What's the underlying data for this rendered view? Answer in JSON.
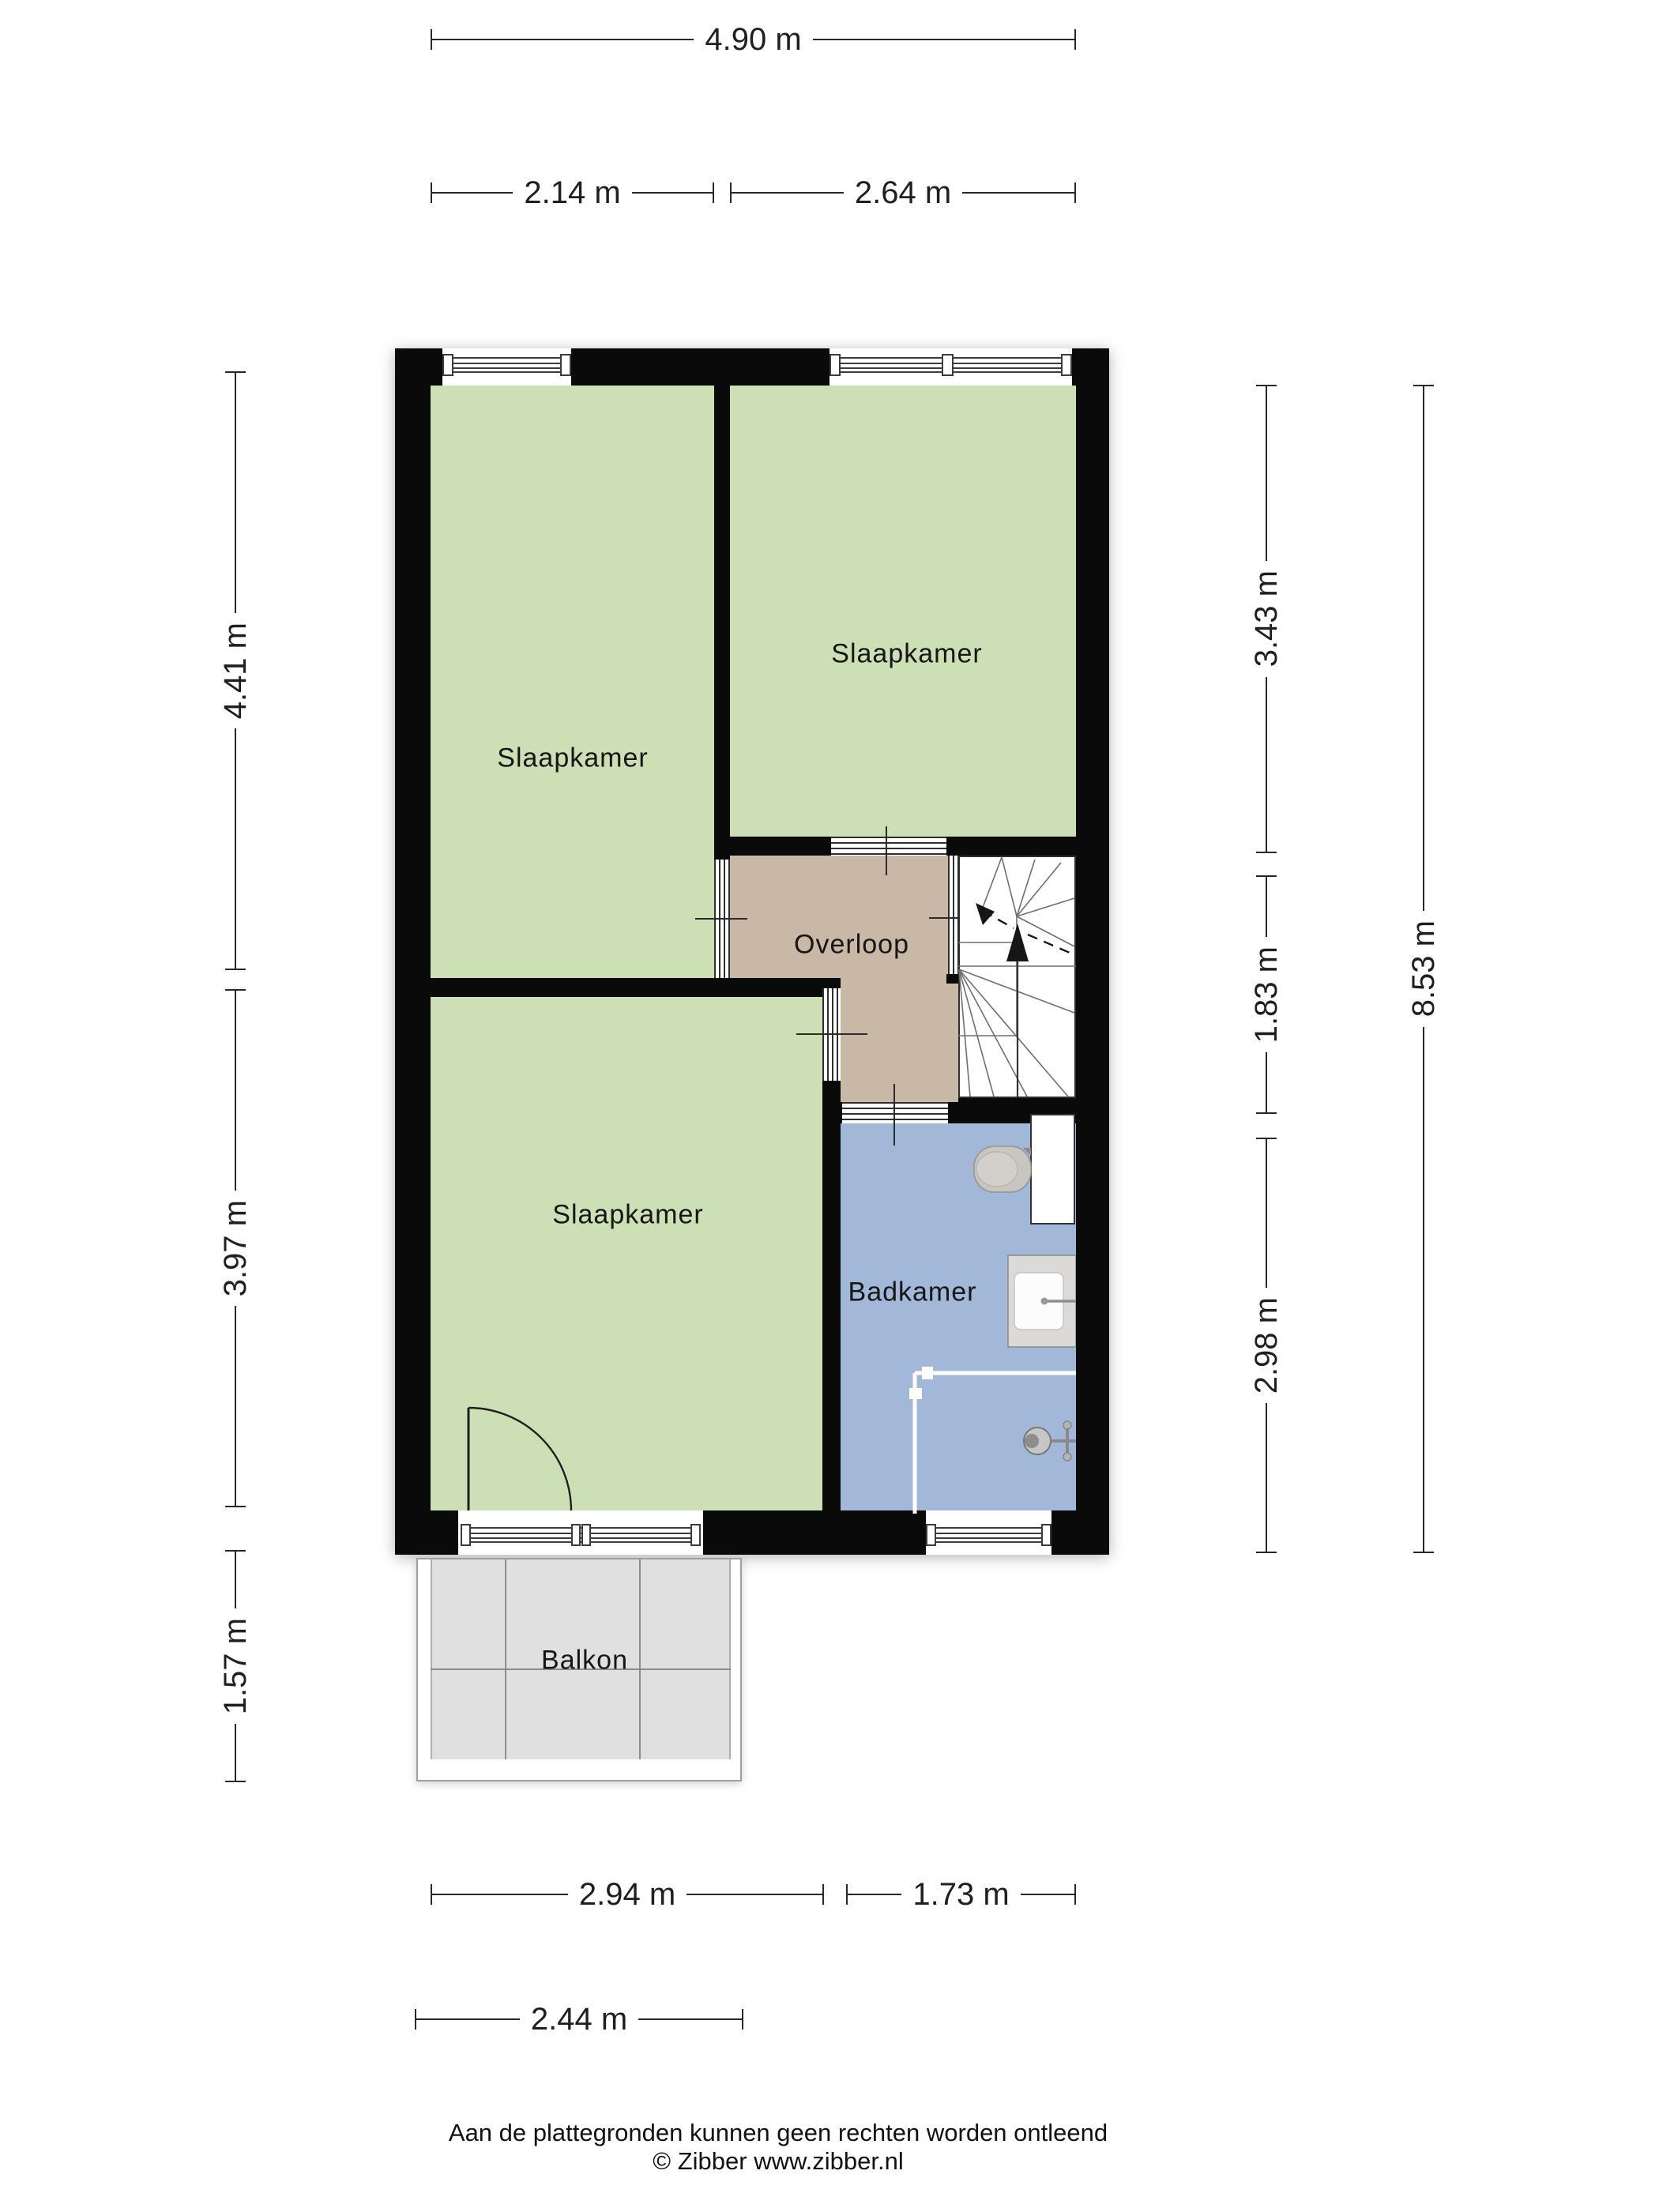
{
  "page": {
    "background": "#ffffff"
  },
  "colors": {
    "wall": "#0a0a0a",
    "room-green": "#cde0b5",
    "room-tan": "#c9b8a6",
    "room-blue": "#a2b8d8",
    "balcony-floor": "#e0e0e0",
    "dim": "#1f1f1f"
  },
  "rooms": {
    "bedroom_top_left": {
      "label": "Slaapkamer"
    },
    "bedroom_top_right": {
      "label": "Slaapkamer"
    },
    "bedroom_bottom": {
      "label": "Slaapkamer"
    },
    "landing": {
      "label": "Overloop"
    },
    "bathroom": {
      "label": "Badkamer"
    },
    "balcony": {
      "label": "Balkon"
    }
  },
  "dimensions": {
    "top_total": "4.90 m",
    "top_left": "2.14 m",
    "top_right": "2.64 m",
    "left_upper": "4.41 m",
    "left_middle": "3.97 m",
    "left_lower": "1.57 m",
    "right_upper": "3.43 m",
    "right_middle": "1.83 m",
    "right_lower": "2.98 m",
    "right_total": "8.53 m",
    "bottom_left": "2.94 m",
    "bottom_right": "1.73 m",
    "balcony_width": "2.44 m"
  },
  "footer": {
    "disclaimer": "Aan de plattegronden kunnen geen rechten worden ontleend",
    "credit": "© Zibber www.zibber.nl"
  }
}
